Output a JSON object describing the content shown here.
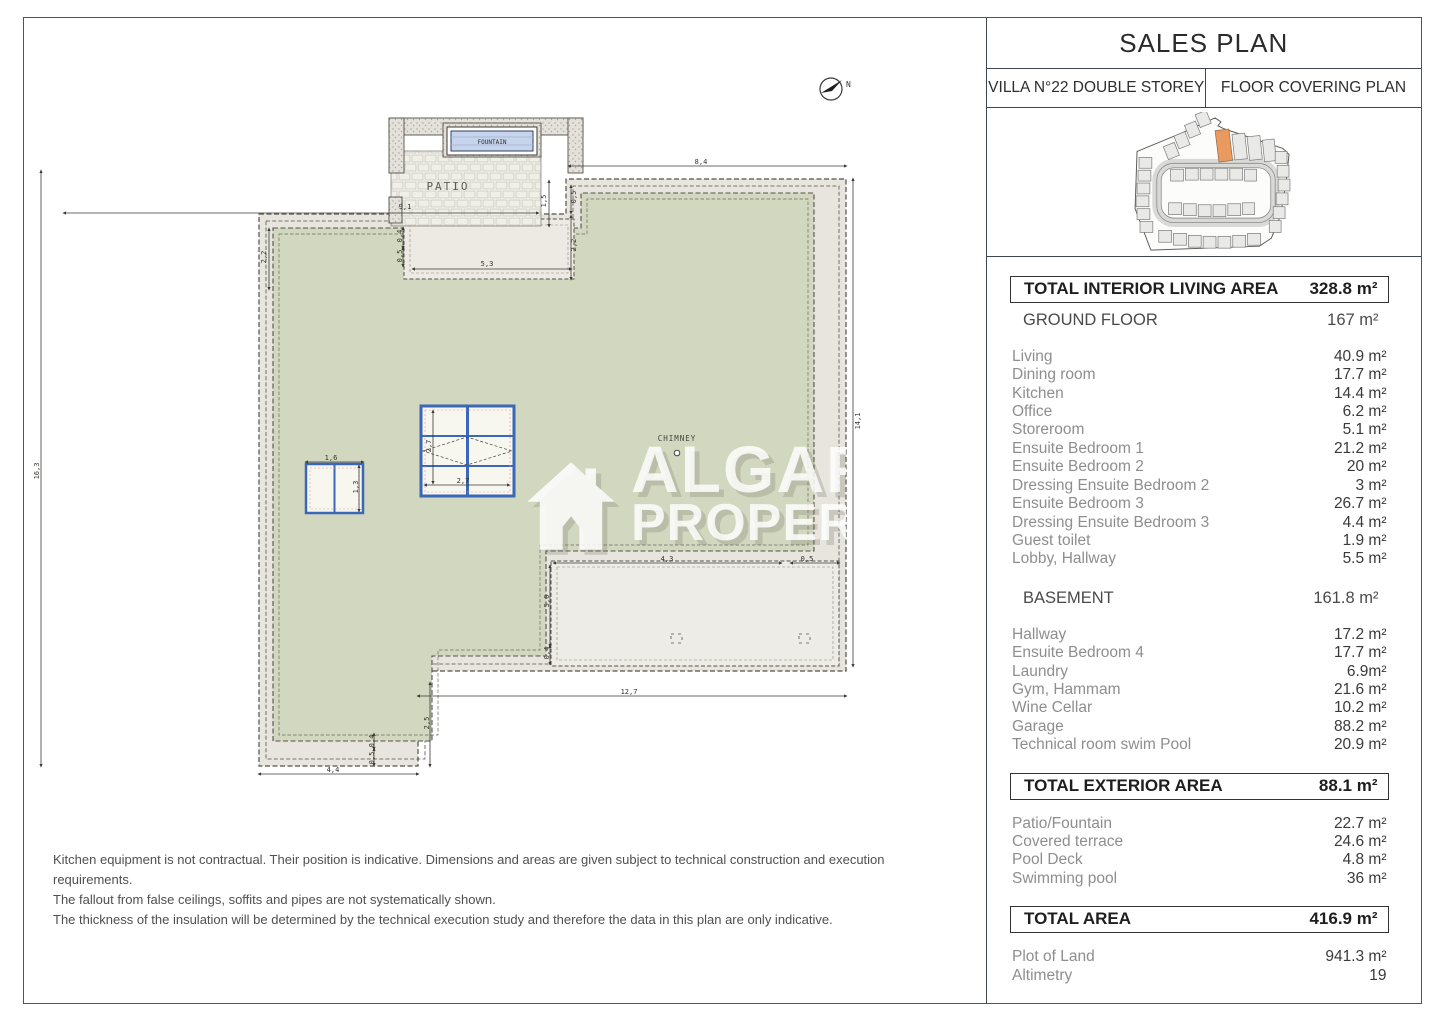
{
  "title_block": {
    "title": "SALES PLAN",
    "villa": "VILLA N°22 DOUBLE STOREY",
    "plan_type": "FLOOR COVERING PLAN"
  },
  "colors": {
    "roof_green": "#d2d8bf",
    "band_gray": "#e7e5de",
    "terrace_gray": "#edece6",
    "skylight_blue": "#3a67b8",
    "site_highlight": "#eb9a5f"
  },
  "sidebar": {
    "sections": [
      {
        "style": "bold",
        "label": "TOTAL INTERIOR LIVING AREA",
        "value": "328.8 m²"
      },
      {
        "style": "plain",
        "label": "GROUND FLOOR",
        "value": "167 m²"
      },
      {
        "style": "rooms",
        "rows": [
          [
            "Living",
            "40.9 m²"
          ],
          [
            "Dining room",
            "17.7 m²"
          ],
          [
            "Kitchen",
            "14.4 m²"
          ],
          [
            "Office",
            "6.2 m²"
          ],
          [
            "Storeroom",
            "5.1 m²"
          ],
          [
            "Ensuite Bedroom 1",
            "21.2 m²"
          ],
          [
            "Ensuite Bedroom 2",
            "20 m²"
          ],
          [
            "Dressing Ensuite Bedroom 2",
            "3 m²"
          ],
          [
            "Ensuite Bedroom 3",
            "26.7 m²"
          ],
          [
            "Dressing Ensuite Bedroom 3",
            "4.4 m²"
          ],
          [
            "Guest toilet",
            "1.9 m²"
          ],
          [
            "Lobby, Hallway",
            "5.5 m²"
          ]
        ]
      },
      {
        "style": "plain",
        "label": "BASEMENT",
        "value": "161.8 m²"
      },
      {
        "style": "rooms",
        "rows": [
          [
            "Hallway",
            "17.2 m²"
          ],
          [
            "Ensuite Bedroom 4",
            "17.7 m²"
          ],
          [
            "Laundry",
            "6.9m²"
          ],
          [
            "Gym, Hammam",
            "21.6 m²"
          ],
          [
            "Wine Cellar",
            "10.2 m²"
          ],
          [
            "Garage",
            "88.2 m²"
          ],
          [
            "Technical room swim Pool",
            "20.9 m²"
          ]
        ]
      },
      {
        "style": "bold",
        "label": "TOTAL EXTERIOR AREA",
        "value": "88.1 m²"
      },
      {
        "style": "rooms",
        "rows": [
          [
            "Patio/Fountain",
            "22.7 m²"
          ],
          [
            "Covered terrace",
            "24.6 m²"
          ],
          [
            "Pool Deck",
            "4.8 m²"
          ],
          [
            "Swimming pool",
            "36 m²"
          ]
        ]
      },
      {
        "style": "bold",
        "label": "TOTAL AREA",
        "value": "416.9 m²"
      },
      {
        "style": "rooms",
        "rows": [
          [
            "Plot of Land",
            "941.3 m²"
          ],
          [
            "Altimetry",
            "19"
          ]
        ]
      }
    ]
  },
  "plan": {
    "labels": {
      "patio": "PATIO",
      "fountain": "FOUNTAIN",
      "chimney": "CHIMNEY",
      "north": "N"
    },
    "watermark_line1": "ALGARVE",
    "watermark_line2": "PROPERTY",
    "dimensions": [
      {
        "t": "9,1",
        "x": 404,
        "y": 206,
        "r": 0
      },
      {
        "t": "8,4",
        "x": 700,
        "y": 161,
        "r": 0
      },
      {
        "t": "16,3",
        "x": 36,
        "y": 470,
        "r": -90
      },
      {
        "t": "14,1",
        "x": 857,
        "y": 420,
        "r": -90
      },
      {
        "t": "12,7",
        "x": 628,
        "y": 691,
        "r": 0
      },
      {
        "t": "4,4",
        "x": 332,
        "y": 769,
        "r": 0
      },
      {
        "t": "2,5",
        "x": 426,
        "y": 722,
        "r": -90
      },
      {
        "t": "5,3",
        "x": 486,
        "y": 263,
        "r": 0
      },
      {
        "t": "1,5",
        "x": 543,
        "y": 200,
        "r": -90
      },
      {
        "t": "0,5",
        "x": 573,
        "y": 196,
        "r": -90
      },
      {
        "t": "2,2",
        "x": 573,
        "y": 244,
        "r": -90
      },
      {
        "t": "2,2",
        "x": 263,
        "y": 256,
        "r": -90
      },
      {
        "t": "0,4",
        "x": 399,
        "y": 235,
        "r": -90
      },
      {
        "t": "0,5",
        "x": 399,
        "y": 255,
        "r": -90
      },
      {
        "t": "4,3",
        "x": 666,
        "y": 558,
        "r": 0
      },
      {
        "t": "0,5",
        "x": 806,
        "y": 558,
        "r": 0
      },
      {
        "t": "5,0",
        "x": 546,
        "y": 600,
        "r": -90
      },
      {
        "t": "0,4",
        "x": 546,
        "y": 652,
        "r": -90
      },
      {
        "t": "2,7",
        "x": 428,
        "y": 445,
        "r": -90
      },
      {
        "t": "2,7",
        "x": 462,
        "y": 480,
        "r": 0
      },
      {
        "t": "1,6",
        "x": 330,
        "y": 457,
        "r": 0
      },
      {
        "t": "1,3",
        "x": 355,
        "y": 486,
        "r": -90
      },
      {
        "t": "0,4",
        "x": 371,
        "y": 740,
        "r": -90
      },
      {
        "t": "0,5",
        "x": 371,
        "y": 757,
        "r": -90
      }
    ]
  },
  "footnotes": [
    "Kitchen equipment is not contractual. Their position is indicative. Dimensions and areas are given subject to technical construction and execution requirements.",
    "The fallout from false ceilings, soffits and pipes are not systematically shown.",
    "The thickness of the insulation will be determined by the technical execution study and therefore the data in this plan are only indicative."
  ]
}
